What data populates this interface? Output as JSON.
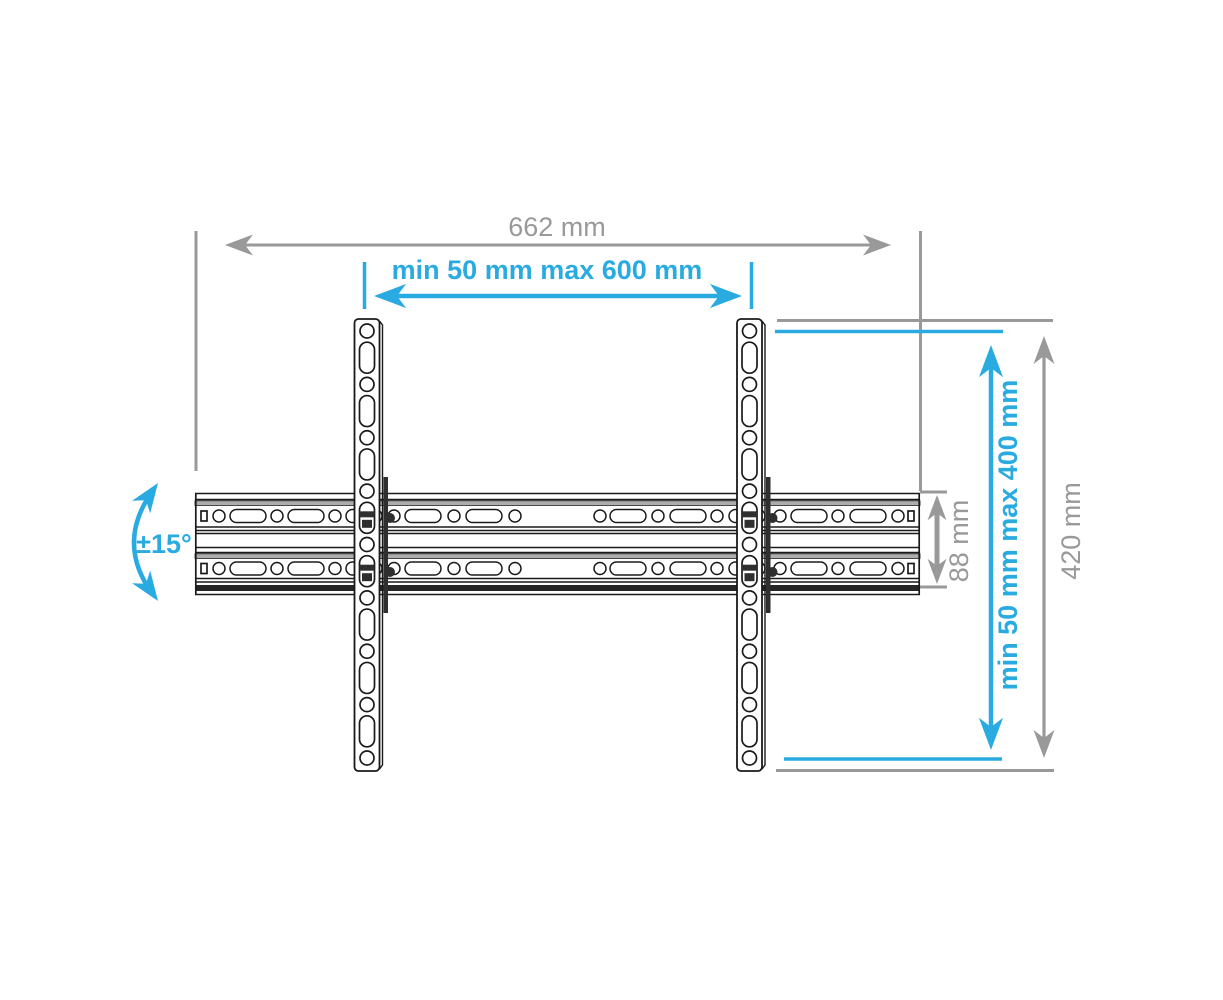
{
  "diagram": {
    "kind": "technical-dimension-drawing",
    "colors": {
      "accent_cyan": "#29abe2",
      "dimension_gray": "#999999",
      "outline_dark": "#1a1a1a"
    },
    "dimensions": {
      "total_width": "662 mm",
      "mount_width_range": "min 50 mm max 600 mm",
      "tilt_angle": "±15°",
      "plate_height": "88 mm",
      "mount_height_range": "min 50 mm max 400 mm",
      "total_height": "420 mm"
    }
  }
}
